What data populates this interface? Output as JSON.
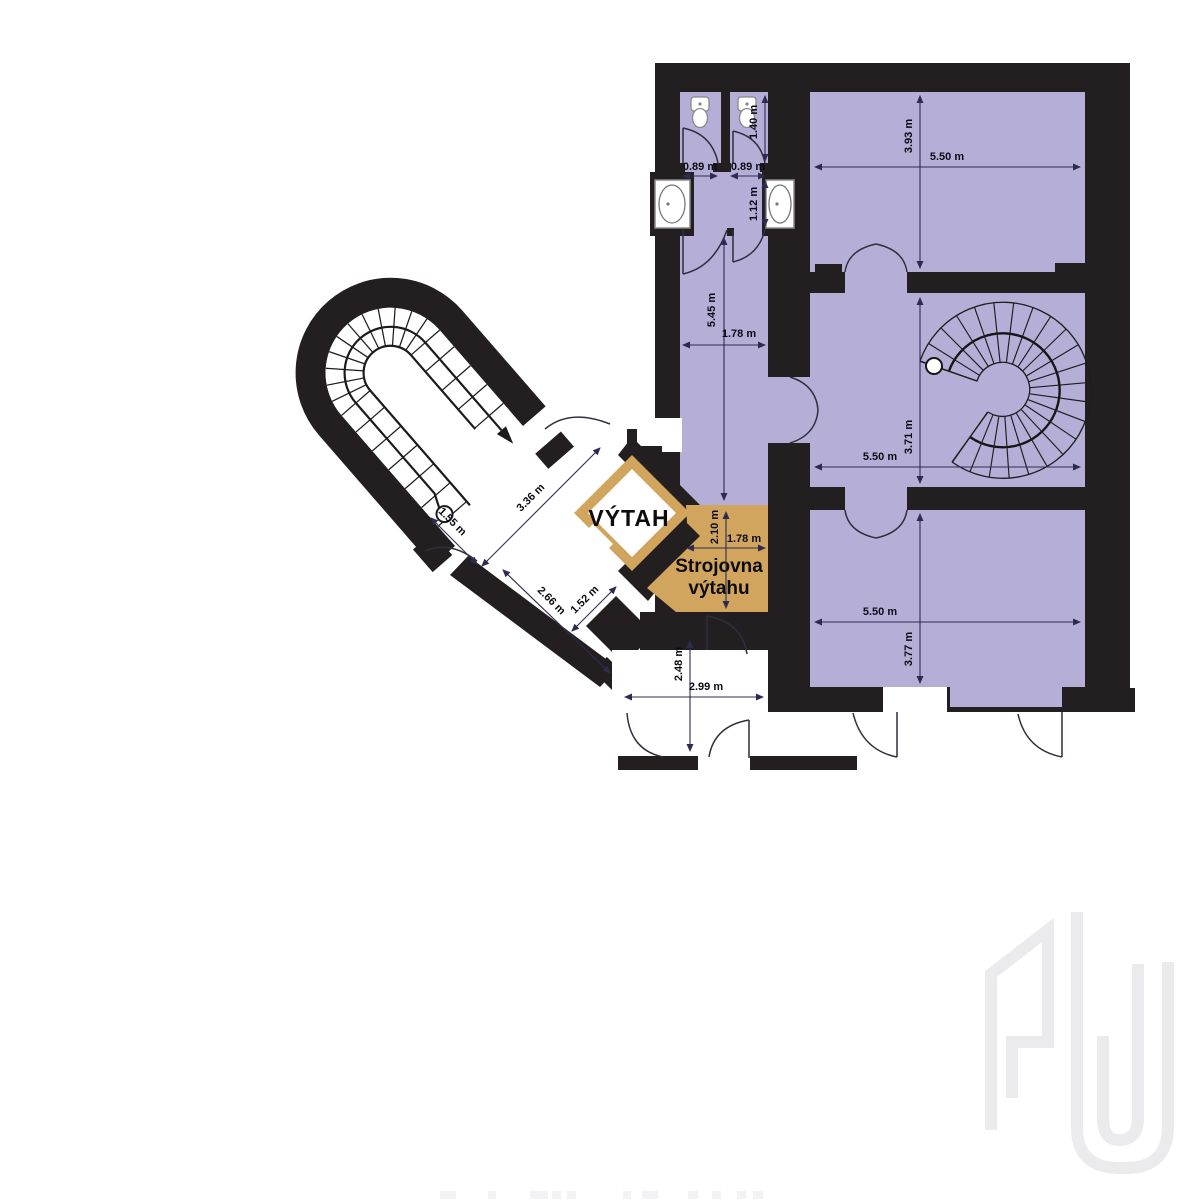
{
  "floorplan": {
    "elevator": {
      "label": "VÝTAH"
    },
    "machine_room": {
      "label_line1": "Strojovna",
      "label_line2": "výtahu",
      "width": "1.78 m",
      "height": "2.10 m"
    },
    "rooms": {
      "room_top": {
        "width": "5.50 m",
        "height": "3.93 m"
      },
      "room_middle": {
        "width": "5.50 m",
        "height": "3.71 m"
      },
      "room_bottom": {
        "width": "5.50 m",
        "height": "3.77 m"
      },
      "wc_left": {
        "door_width": "0.89 m"
      },
      "wc_right": {
        "door_width": "0.89 m",
        "depth": "1.40 m"
      },
      "sink_bay": {
        "depth": "1.12 m"
      },
      "corridor": {
        "length": "5.45 m",
        "width": "1.78 m"
      },
      "landing": {
        "dim_a": "1.55 m",
        "dim_b": "3.36 m",
        "dim_c": "2.66 m",
        "dim_d": "1.52 m"
      },
      "vestibule": {
        "height": "2.48 m",
        "width": "2.99 m"
      }
    },
    "colors": {
      "wall": "#231f20",
      "room_fill": "#b5afd7",
      "highlight_fill": "#d2a55e",
      "dimension_text": "#0b0b14",
      "watermark": "#ebebee"
    },
    "watermark": {
      "logo": "GU"
    }
  }
}
